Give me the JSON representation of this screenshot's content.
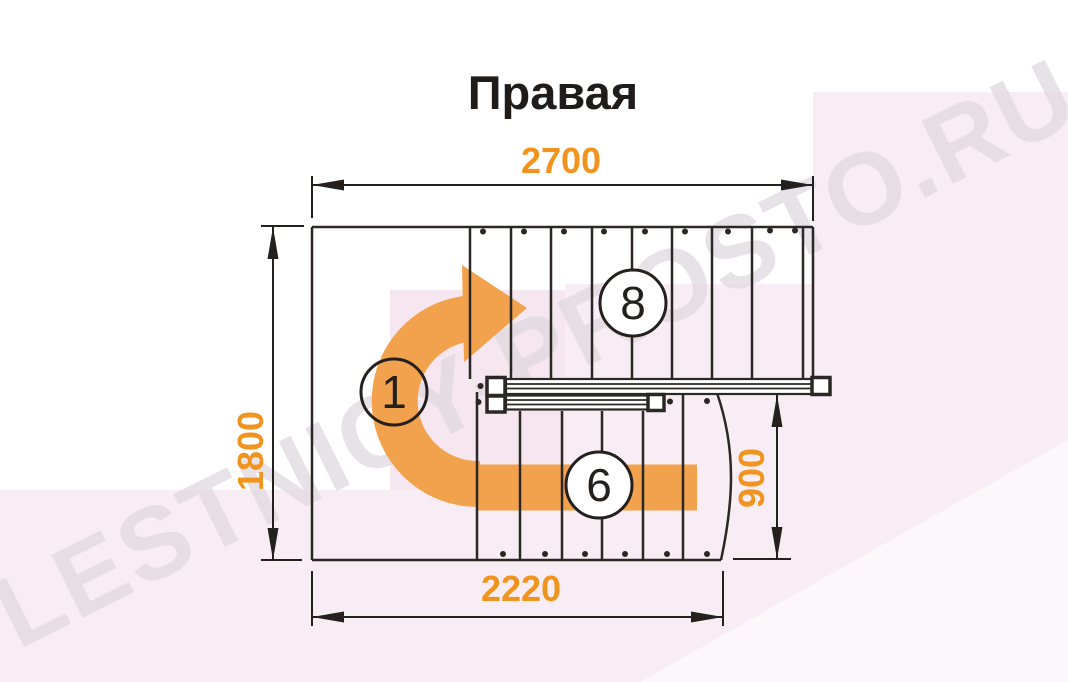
{
  "title": "Правая",
  "watermark": "LESTNICY-PROSTO.RU",
  "dimensions": {
    "top_width_mm": "2700",
    "left_height_mm": "1800",
    "right_height_mm": "900",
    "bottom_width_mm": "2220"
  },
  "step_labels": {
    "entry_area": "1",
    "lower_flight": "6",
    "upper_flight": "8"
  },
  "colors": {
    "dimension_text": "#F0941F",
    "direction_arrow": "#F2A24D",
    "drawing_lines": "#2B2724",
    "background_tint": "#F8EDF4",
    "background_tint_deep": "#F5E6EF",
    "watermark_text": "#E0D9DF"
  }
}
